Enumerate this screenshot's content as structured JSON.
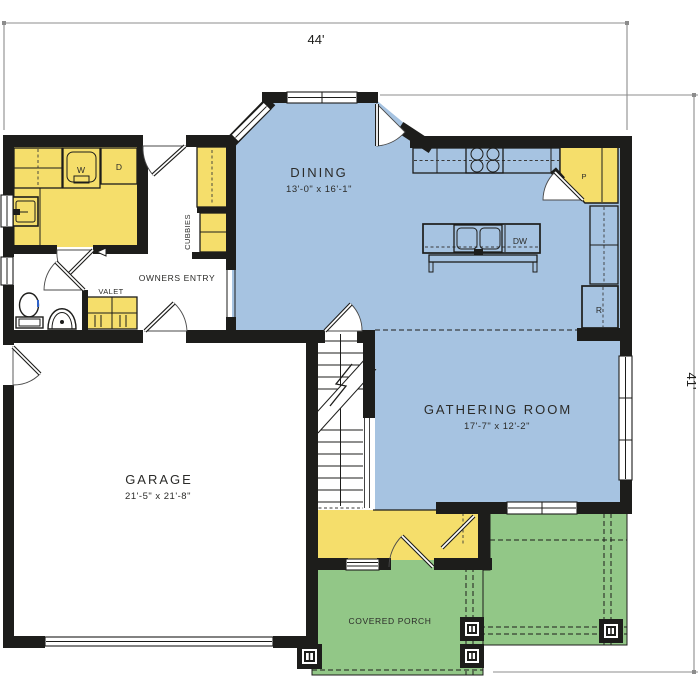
{
  "dimensions": {
    "width_label": "44'",
    "height_label": "41'"
  },
  "rooms": {
    "dining": {
      "name": "DINING",
      "size": "13'-0\" x 16'-1\""
    },
    "gathering": {
      "name": "GATHERING ROOM",
      "size": "17'-7\" x 12'-2\""
    },
    "garage": {
      "name": "GARAGE",
      "size": "21'-5\" x 21'-8\""
    },
    "covered_porch": {
      "name": "COVERED PORCH"
    },
    "owners_entry": {
      "name": "OWNERS ENTRY"
    },
    "valet": {
      "name": "VALET"
    },
    "cubbies": {
      "name": "CUBBIES"
    }
  },
  "appliances": {
    "washer": "W",
    "dryer": "D",
    "dishwasher": "DW",
    "pantry": "P",
    "refrigerator": "R"
  },
  "colors": {
    "living_area": "#a6c3e1",
    "cabinetry": "#f5de6b",
    "porch": "#92c787",
    "wall": "#1d1d1b",
    "dimension_line": "#8c8c8c",
    "label_text": "#2b2b29",
    "fixture_accent": "#2e62c9"
  }
}
